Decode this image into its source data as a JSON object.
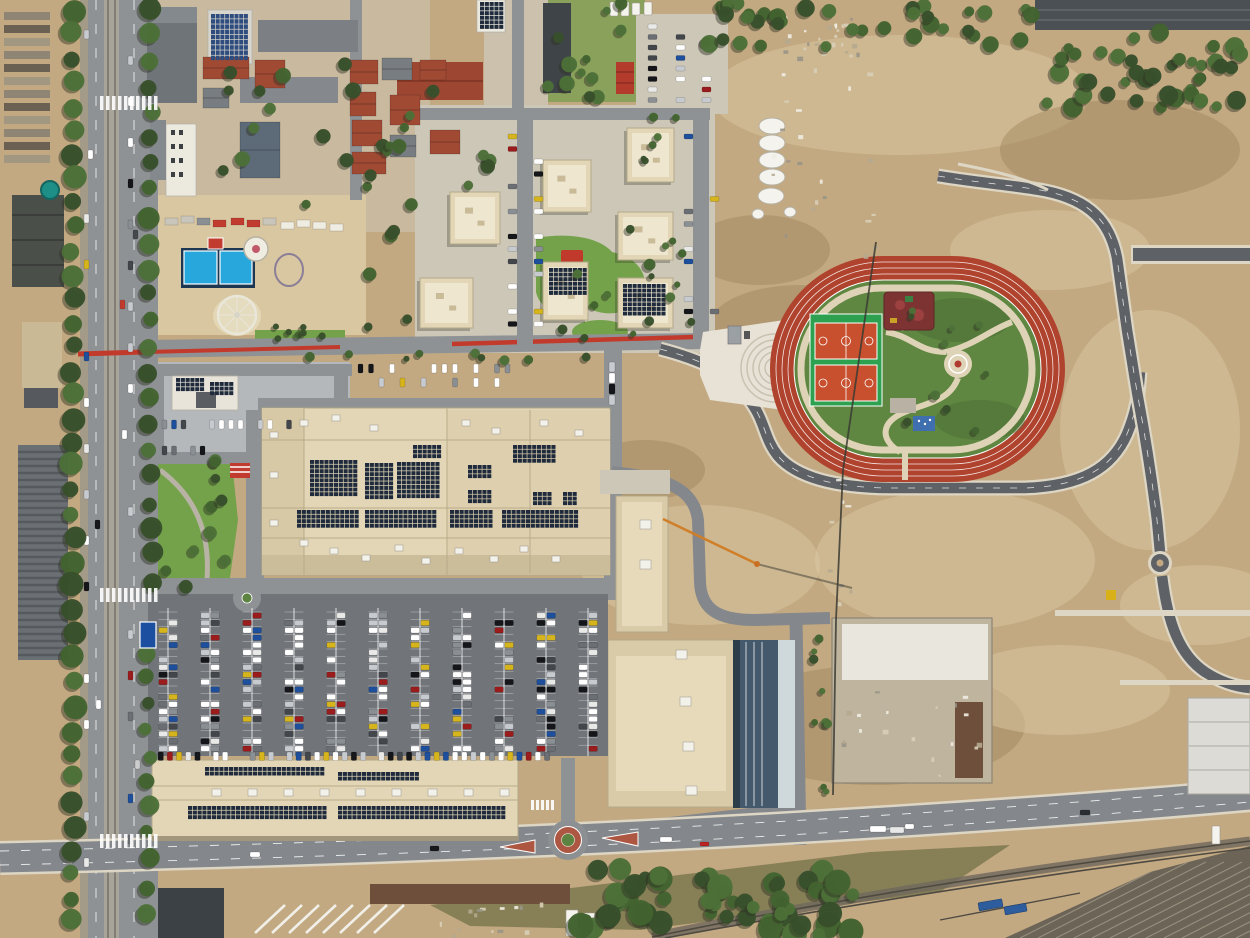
{
  "scene": {
    "kind": "aerial-drone-photograph",
    "description": "top-down view of an urban district: shopping mall with rooftop solar, large car park, residential blocks, athletics track park with basketball courts, fairground, construction land, boulevard with tram line, railway yard"
  },
  "palette": {
    "dirt": "#c3a982",
    "dirt_light": "#d9c7a2",
    "dirt_dark": "#a2885f",
    "dirt_pale": "#e4d7b5",
    "concrete": "#cdc7b8",
    "concrete_bright": "#e7e2d5",
    "road": "#8f9295",
    "road_dark": "#5e6266",
    "road_mid": "#84878b",
    "parking": "#71757a",
    "white": "#f4f3ee",
    "curb": "#ddd6c4",
    "roof_beige": "#e2d6b6",
    "roof_beige2": "#d9cba8",
    "roof_tan": "#c9b995",
    "roof_light": "#eee6cf",
    "solar": "#1f2b3c",
    "solar_blue": "#2e4c7e",
    "gray_roof": "#787d81",
    "gray_dark": "#45494d",
    "gray_mid": "#9aa0a3",
    "red_roof": "#a04a34",
    "rust": "#6e4f3c",
    "track_red": "#b0432e",
    "court_green": "#2da14f",
    "court_orange": "#c8502e",
    "grass": "#5f8742",
    "grass_dark": "#4a6b33",
    "lawn": "#74a24b",
    "tree": "#384f2b",
    "tree_light": "#4c7038",
    "scrub": "#7d7950",
    "pool": "#28a7dc",
    "teal": "#1e8f86",
    "path_beige": "#ded3b6",
    "red_lane": "#c23a2c",
    "brick": "#ad5743",
    "playground_red": "#7e3333",
    "rail_bed": "#6f685c",
    "rail_line": "#4e4a42",
    "rail_stripe": "#968d7c",
    "rail_yard": "#6b6457",
    "wagon_blue": "#2e5d9e",
    "sign_blue": "#1d4fa1",
    "shadow": "#2e3324",
    "blue_bldg": "#44596b"
  },
  "car_colors": [
    "#ffffff",
    "#ffffff",
    "#ffffff",
    "#e9e9e7",
    "#c7cbd0",
    "#c7cbd0",
    "#15161a",
    "#15161a",
    "#43474c",
    "#9b1c1c",
    "#1d4f9c",
    "#6b6f74",
    "#d6b51c",
    "#8a8f94"
  ],
  "dirt_patches": [
    [
      900,
      95,
      190,
      60,
      1
    ],
    [
      1120,
      150,
      120,
      50,
      0
    ],
    [
      800,
      325,
      90,
      40,
      0
    ],
    [
      700,
      565,
      120,
      60,
      1
    ],
    [
      955,
      560,
      140,
      70,
      1
    ],
    [
      1150,
      430,
      90,
      120,
      1
    ],
    [
      875,
      725,
      150,
      60,
      0
    ],
    [
      1050,
      250,
      100,
      40,
      1
    ],
    [
      645,
      470,
      60,
      30,
      0
    ],
    [
      1200,
      605,
      80,
      40,
      1
    ],
    [
      760,
      250,
      70,
      35,
      0
    ],
    [
      1060,
      690,
      110,
      45,
      1
    ]
  ],
  "solar_arrays": [
    {
      "x": 310,
      "y": 460,
      "c": 10,
      "r": 8
    },
    {
      "x": 365,
      "y": 463,
      "c": 6,
      "r": 8
    },
    {
      "x": 397,
      "y": 462,
      "c": 9,
      "r": 8
    },
    {
      "x": 413,
      "y": 445,
      "c": 6,
      "r": 3
    },
    {
      "x": 468,
      "y": 465,
      "c": 5,
      "r": 3
    },
    {
      "x": 468,
      "y": 490,
      "c": 5,
      "r": 3
    },
    {
      "x": 513,
      "y": 445,
      "c": 9,
      "r": 4
    },
    {
      "x": 533,
      "y": 492,
      "c": 4,
      "r": 3
    },
    {
      "x": 563,
      "y": 492,
      "c": 3,
      "r": 3
    },
    {
      "x": 297,
      "y": 510,
      "c": 13,
      "r": 4
    },
    {
      "x": 365,
      "y": 510,
      "c": 15,
      "r": 4
    },
    {
      "x": 450,
      "y": 510,
      "c": 9,
      "r": 4
    },
    {
      "x": 502,
      "y": 510,
      "c": 16,
      "r": 4
    },
    {
      "x": 176,
      "y": 378,
      "c": 6,
      "r": 3
    },
    {
      "x": 210,
      "y": 382,
      "c": 5,
      "r": 3
    },
    {
      "x": 211,
      "y": 14,
      "c": 8,
      "r": 9,
      "f": "solar_blue",
      "cw": 4.7,
      "ch": 5.2
    },
    {
      "x": 480,
      "y": 2,
      "c": 5,
      "r": 6
    },
    {
      "x": 205,
      "y": 767,
      "c": 25,
      "r": 2
    },
    {
      "x": 338,
      "y": 772,
      "c": 17,
      "r": 2
    },
    {
      "x": 188,
      "y": 806,
      "c": 29,
      "r": 3
    },
    {
      "x": 338,
      "y": 806,
      "c": 35,
      "r": 3
    },
    {
      "x": 549,
      "y": 268,
      "c": 8,
      "r": 6
    },
    {
      "x": 623,
      "y": 284,
      "c": 9,
      "r": 7
    }
  ],
  "apartment_blocks": [
    {
      "x": 543,
      "y": 160,
      "w": 48,
      "h": 52
    },
    {
      "x": 627,
      "y": 128,
      "w": 47,
      "h": 54
    },
    {
      "x": 450,
      "y": 192,
      "w": 50,
      "h": 52
    },
    {
      "x": 618,
      "y": 212,
      "w": 55,
      "h": 48
    },
    {
      "x": 420,
      "y": 278,
      "w": 53,
      "h": 50
    },
    {
      "x": 543,
      "y": 262,
      "w": 45,
      "h": 58,
      "solar": 1
    },
    {
      "x": 618,
      "y": 278,
      "w": 55,
      "h": 50,
      "solar": 1
    }
  ],
  "houses": [
    [
      203,
      57,
      46,
      22,
      "r"
    ],
    [
      255,
      60,
      30,
      28,
      "r"
    ],
    [
      240,
      122,
      40,
      56,
      "b"
    ],
    [
      203,
      88,
      26,
      20,
      "g"
    ],
    [
      350,
      60,
      28,
      24,
      "r"
    ],
    [
      382,
      58,
      30,
      22,
      "g"
    ],
    [
      350,
      92,
      26,
      24,
      "r"
    ],
    [
      352,
      120,
      30,
      26,
      "r"
    ],
    [
      390,
      95,
      30,
      30,
      "r"
    ],
    [
      352,
      152,
      34,
      22,
      "r"
    ],
    [
      390,
      135,
      26,
      22,
      "g"
    ],
    [
      420,
      60,
      26,
      20,
      "r"
    ],
    [
      430,
      130,
      30,
      24,
      "r"
    ]
  ],
  "silos": [
    [
      772,
      126
    ],
    [
      772,
      143
    ],
    [
      772,
      160
    ],
    [
      772,
      177
    ],
    [
      771,
      196
    ],
    [
      790,
      212
    ],
    [
      758,
      214
    ]
  ],
  "trailers": [
    [
      165,
      218
    ],
    [
      181,
      216
    ],
    [
      197,
      218
    ],
    [
      213,
      220
    ],
    [
      231,
      218
    ],
    [
      247,
      220
    ],
    [
      263,
      218
    ],
    [
      281,
      222
    ],
    [
      297,
      220
    ],
    [
      313,
      222
    ],
    [
      330,
      224
    ]
  ],
  "zebras": [
    {
      "x": 100,
      "y": 588,
      "n": 10,
      "dx": 6,
      "w": 3.5,
      "h": 14
    },
    {
      "x": 100,
      "y": 834,
      "n": 10,
      "dx": 6,
      "w": 3.5,
      "h": 14
    },
    {
      "x": 100,
      "y": 96,
      "n": 10,
      "dx": 6,
      "w": 3.5,
      "h": 14
    },
    {
      "x": 531,
      "y": 800,
      "n": 5,
      "dx": 5,
      "w": 3,
      "h": 10
    }
  ],
  "tree_rows": [
    {
      "x": 73,
      "y0": 10,
      "y1": 930,
      "step": 24,
      "r": 10
    },
    {
      "x": 150,
      "y0": 8,
      "y1": 580,
      "step": 26,
      "r": 9
    },
    {
      "x": 148,
      "y0": 652,
      "y1": 930,
      "step": 26,
      "r": 8
    }
  ],
  "tree_regions": [
    [
      578,
      868,
      858,
      936,
      55,
      6,
      13
    ],
    [
      695,
      2,
      1040,
      48,
      40,
      5,
      9
    ],
    [
      1042,
      32,
      1250,
      108,
      40,
      5,
      10
    ],
    [
      540,
      228,
      700,
      340,
      12,
      3,
      5
    ],
    [
      200,
      40,
      490,
      205,
      22,
      4,
      8
    ],
    [
      548,
      2,
      645,
      100,
      12,
      4,
      8
    ],
    [
      255,
      326,
      345,
      342,
      7,
      3,
      5
    ],
    [
      152,
      455,
      250,
      590,
      10,
      4,
      7
    ],
    [
      880,
      300,
      1035,
      455,
      10,
      3,
      5
    ],
    [
      812,
      632,
      830,
      798,
      9,
      3,
      5
    ],
    [
      640,
      112,
      692,
      340,
      10,
      3,
      6
    ],
    [
      365,
      125,
      415,
      330,
      10,
      4,
      7
    ],
    [
      295,
      352,
      600,
      362,
      9,
      3,
      5
    ]
  ],
  "parking": {
    "rowxs": [
      168,
      210,
      252,
      294,
      336,
      378,
      420,
      462,
      504,
      546,
      588
    ],
    "y_top": 612,
    "y_bot": 754,
    "slots": 19,
    "step": 7.4,
    "occ": 0.62
  },
  "south_row": {
    "x0": 158,
    "x1": 545,
    "y": 752,
    "step": 9.2,
    "w": 5.4,
    "h": 8.5,
    "occ": 0.85
  },
  "car_rows": [
    [
      508,
      134,
      0,
      12.5,
      16,
      9,
      5,
      0.65
    ],
    [
      534,
      134,
      0,
      12.5,
      16,
      9,
      5,
      0.6
    ],
    [
      684,
      134,
      0,
      12.5,
      16,
      9,
      5,
      0.6
    ],
    [
      710,
      134,
      0,
      12.5,
      16,
      9,
      5,
      0.5
    ],
    [
      84,
      30,
      0,
      46,
      19,
      5,
      9,
      0.5
    ],
    [
      128,
      15,
      0,
      41,
      22,
      5,
      9,
      0.5
    ],
    [
      358,
      364,
      10.5,
      0,
      15,
      5,
      9,
      0.6
    ],
    [
      358,
      378,
      10.5,
      0,
      15,
      5,
      9,
      0.4
    ],
    [
      648,
      24,
      0,
      10.5,
      8,
      9,
      5,
      0.7
    ],
    [
      676,
      24,
      0,
      10.5,
      8,
      9,
      5,
      0.6
    ],
    [
      702,
      24,
      0,
      10.5,
      8,
      9,
      5,
      0.6
    ],
    [
      162,
      420,
      9.5,
      0,
      9,
      5,
      9,
      0.7
    ],
    [
      162,
      446,
      9.5,
      0,
      9,
      5,
      9,
      0.6
    ],
    [
      258,
      420,
      9.5,
      0,
      5,
      5,
      9,
      0.5
    ],
    [
      609,
      362,
      0,
      11,
      4,
      6,
      10,
      0.8
    ]
  ],
  "vehicles": [
    [
      250,
      852,
      10,
      5,
      "#ffffff"
    ],
    [
      430,
      846,
      9,
      5,
      "#17181c"
    ],
    [
      660,
      837,
      12,
      5,
      "#ffffff"
    ],
    [
      905,
      824,
      9,
      5,
      "#ffffff"
    ],
    [
      1080,
      810,
      10,
      5,
      "#2b2e33"
    ],
    [
      700,
      842,
      9,
      4,
      "#bb2222"
    ],
    [
      120,
      300,
      5,
      9,
      "#c23b2f"
    ],
    [
      122,
      430,
      5,
      9,
      "#ffffff"
    ],
    [
      95,
      520,
      5,
      9,
      "#17181c"
    ],
    [
      870,
      826,
      16,
      6,
      "#ffffff"
    ],
    [
      890,
      827,
      14,
      6,
      "#e8e8e8"
    ],
    [
      96,
      700,
      5,
      9,
      "#ffffff"
    ],
    [
      135,
      760,
      5,
      9,
      "#cccccc"
    ],
    [
      88,
      150,
      5,
      9,
      "#ffffff"
    ],
    [
      133,
      230,
      5,
      9,
      "#45484d"
    ]
  ],
  "trucks": [
    [
      566,
      910,
      12,
      26
    ],
    [
      583,
      913,
      12,
      24
    ],
    [
      1212,
      826,
      8,
      18
    ],
    [
      610,
      2,
      8,
      14
    ],
    [
      621,
      2,
      8,
      14
    ],
    [
      632,
      3,
      8,
      12
    ],
    [
      644,
      2,
      8,
      13
    ]
  ],
  "wagons": [
    [
      978,
      903,
      24,
      8
    ],
    [
      1004,
      907,
      22,
      8
    ]
  ],
  "material_stacks": {
    "x": 4,
    "y0": 12,
    "y1": 168,
    "step": 13,
    "w": 46,
    "h": 8
  },
  "hvac_mall": [
    [
      300,
      540
    ],
    [
      330,
      548
    ],
    [
      362,
      555
    ],
    [
      395,
      545
    ],
    [
      422,
      558
    ],
    [
      455,
      548
    ],
    [
      490,
      556
    ],
    [
      520,
      546
    ],
    [
      552,
      556
    ],
    [
      300,
      420
    ],
    [
      332,
      415
    ],
    [
      370,
      425
    ],
    [
      462,
      420
    ],
    [
      492,
      428
    ],
    [
      540,
      420
    ],
    [
      575,
      430
    ],
    [
      270,
      432
    ],
    [
      270,
      472
    ],
    [
      270,
      520
    ]
  ],
  "hvac_l": [
    [
      676,
      650
    ],
    [
      680,
      697
    ],
    [
      683,
      742
    ],
    [
      686,
      786
    ],
    [
      640,
      520
    ],
    [
      640,
      560
    ]
  ],
  "hvac_retail": {
    "y": 789,
    "x0": 212,
    "x1": 500,
    "step": 36
  },
  "debris_regions": [
    [
      750,
      60,
      900,
      255,
      22
    ],
    [
      840,
      688,
      985,
      780,
      18
    ],
    [
      778,
      16,
      862,
      58,
      26
    ],
    [
      815,
      470,
      850,
      610,
      8
    ],
    [
      430,
      902,
      540,
      936,
      14
    ]
  ],
  "beams": {
    "x0": 255,
    "y0": 905,
    "n": 8,
    "dx": 17
  }
}
